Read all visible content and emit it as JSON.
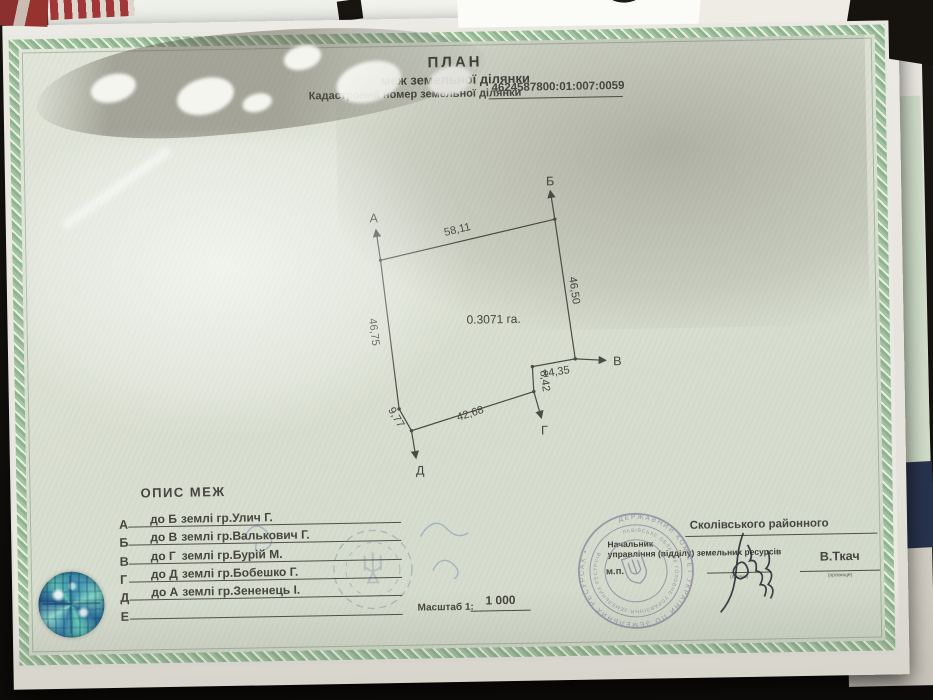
{
  "document": {
    "title_line1": "ПЛАН",
    "title_line2": "меж земельної ділянки",
    "cadastral_label": "Кадастровий номер земельної ділянки",
    "cadastral_number": "4624587800:01:007:0059"
  },
  "diagram": {
    "area_label": "0.3071 га.",
    "points": {
      "a": "А",
      "b": "Б",
      "v": "В",
      "g": "Г",
      "d": "Д"
    },
    "dims": {
      "ab": "58,11",
      "bv": "46,50",
      "vg1": "14,35",
      "vg2": "8,42",
      "gd": "42,68",
      "dd": "9,77",
      "da": "46,75"
    }
  },
  "boundaries": {
    "heading": "ОПИС МЕЖ",
    "rows": [
      {
        "letter": "А",
        "to": "до Б",
        "name": "землі гр.Улич Г."
      },
      {
        "letter": "Б",
        "to": "до В",
        "name": "землі гр.Валькович Г."
      },
      {
        "letter": "В",
        "to": "до Г",
        "name": "землі гр.Бурій М."
      },
      {
        "letter": "Г",
        "to": "до Д",
        "name": "землі гр.Бобешко Г."
      },
      {
        "letter": "Д",
        "to": "до А",
        "name": "землі гр.Зененець І."
      },
      {
        "letter": "Е",
        "to": "",
        "name": ""
      }
    ]
  },
  "scale": {
    "label": "Масштаб 1:",
    "value": "1 000"
  },
  "approval": {
    "district": "Сколівського районного",
    "role_line1": "Начальник",
    "role_line2": "управління (відділу) земельних ресурсів",
    "mp_label": "м.п.",
    "signature_caption": "(підпис)",
    "signer_name": "В.Ткач",
    "name_caption": "(прізвище)"
  },
  "stamp": {
    "outer_ring_text": "ДЕРЖАВНИЙ КОМІТЕТ УКРАЇНИ ПО ЗЕМЕЛЬНИХ РЕСУРСАХ •",
    "inner_ring_text": "ЛЬВІВСЬКЕ ОБЛАСНЕ ГОЛОВНЕ УПРАВЛІННЯ ЗЕМЕЛЬНИХ РЕСУРСІВ"
  },
  "colors": {
    "paper_green": "#dbe0d3",
    "border_green": "#8db48e",
    "ink": "#46453f",
    "stamp_purple": "#8e88a0",
    "sticker_teal": "#4a9bb5"
  }
}
